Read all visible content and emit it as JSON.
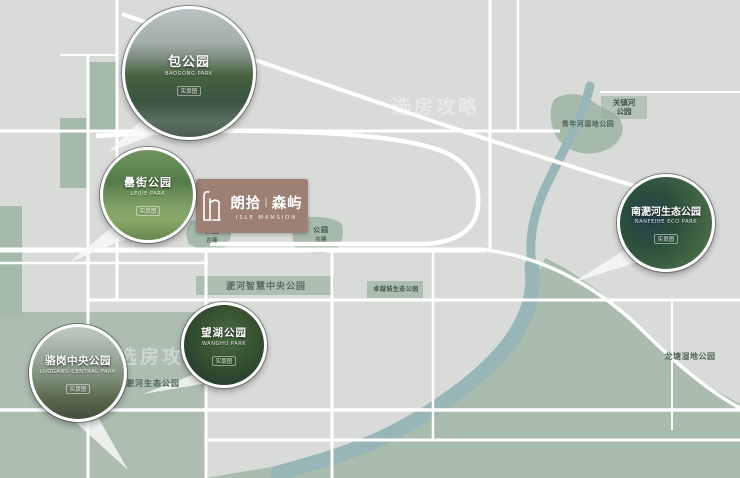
{
  "colors": {
    "background": "#d9dbd9",
    "green_space": "#a6baab",
    "river": "#98b6b8",
    "road": "#ffffff",
    "logo_background": "#9c8074"
  },
  "watermark": {
    "text": "选房攻略"
  },
  "logo": {
    "cn_left": "朗拾",
    "divider": "|",
    "cn_right": "森屿",
    "en": "ISLE MANSION"
  },
  "callouts": [
    {
      "name": "包公园",
      "en": "BAOGONG PARK",
      "tag": "实景图"
    },
    {
      "name": "罍街公园",
      "en": "LEIJIE PARK",
      "tag": "实景图"
    },
    {
      "name": "南淝河生态公园",
      "en": "NANFEIHE ECO PARK",
      "tag": "实景图"
    },
    {
      "name": "骆岗中央公园",
      "en": "LUOGANG CENTRAL PARK",
      "tag": "实景图"
    },
    {
      "name": "望湖公园",
      "en": "WANGHU PARK",
      "tag": "实景图"
    }
  ],
  "map_labels": {
    "guanzhenhe": {
      "line1": "关镇河",
      "line2": "公园"
    },
    "qingnianhe": {
      "text": "青年河湿地公园"
    },
    "feihe_smart": {
      "text": "淝河智慧中央公园"
    },
    "zhuoyuecheng": {
      "text": "卓越城生态公园"
    },
    "feihe_eco": {
      "text": "淝河生态公园"
    },
    "longtang": {
      "text": "龙塘湿地公园"
    },
    "patch_left": {
      "label": "公园",
      "status": "在建"
    },
    "patch_right": {
      "label": "公园",
      "status": "在建"
    }
  }
}
